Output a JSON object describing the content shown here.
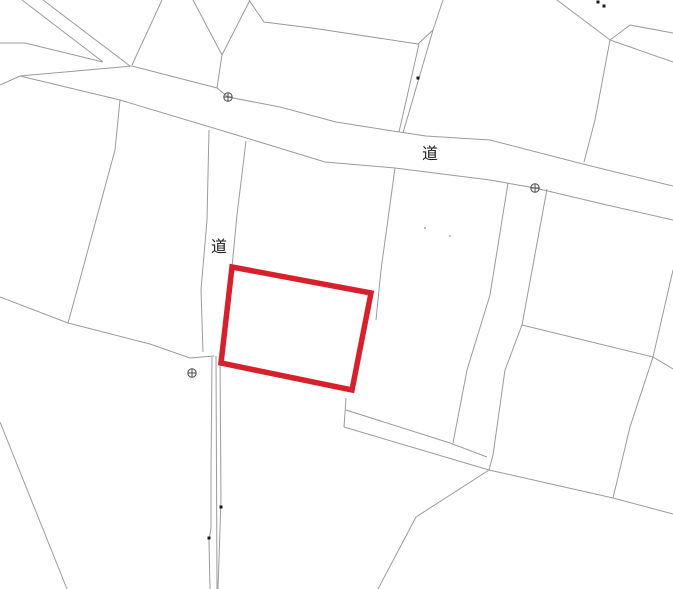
{
  "map": {
    "width": 673,
    "height": 589,
    "background": "#ffffff",
    "boundary_color": "#9b9b9b",
    "boundary_width": 1,
    "labels": [
      {
        "text": "道",
        "x": 430,
        "y": 153,
        "font_size": 16
      },
      {
        "text": "道",
        "x": 219,
        "y": 246,
        "font_size": 16
      }
    ],
    "highlight_parcel": {
      "color": "#d6202c",
      "stroke_width": 5.5,
      "points": [
        [
          232,
          267
        ],
        [
          371,
          293
        ],
        [
          352,
          390
        ],
        [
          221,
          363
        ]
      ]
    },
    "survey_markers": {
      "color": "#4a4a4a",
      "radius": 4.2,
      "positions": [
        [
          228,
          97
        ],
        [
          535,
          188
        ],
        [
          192,
          373
        ]
      ]
    },
    "boundaries": [
      [
        [
          22,
          0
        ],
        [
          103,
          62
        ]
      ],
      [
        [
          43,
          0
        ],
        [
          130,
          66
        ]
      ],
      [
        [
          0,
          43
        ],
        [
          25,
          43
        ],
        [
          103,
          62
        ]
      ],
      [
        [
          0,
          85
        ],
        [
          20,
          76
        ]
      ],
      [
        [
          20,
          76
        ],
        [
          132,
          66
        ],
        [
          217,
          88
        ],
        [
          228,
          97
        ],
        [
          280,
          107
        ],
        [
          336,
          122
        ],
        [
          399,
          132
        ],
        [
          426,
          136
        ],
        [
          490,
          140
        ],
        [
          579,
          163
        ],
        [
          607,
          170
        ],
        [
          673,
          186
        ]
      ],
      [
        [
          20,
          76
        ],
        [
          120,
          100
        ],
        [
          230,
          133
        ],
        [
          325,
          162
        ],
        [
          395,
          168
        ],
        [
          490,
          180
        ],
        [
          535,
          188
        ],
        [
          607,
          205
        ],
        [
          673,
          220
        ]
      ],
      [
        [
          162,
          0
        ],
        [
          132,
          65
        ]
      ],
      [
        [
          193,
          0
        ],
        [
          222,
          55
        ]
      ],
      [
        [
          250,
          0
        ],
        [
          222,
          55
        ]
      ],
      [
        [
          222,
          55
        ],
        [
          217,
          88
        ]
      ],
      [
        [
          249,
          0
        ],
        [
          264,
          22
        ],
        [
          312,
          28
        ],
        [
          418,
          44
        ]
      ],
      [
        [
          419,
          44
        ],
        [
          399,
          132
        ]
      ],
      [
        [
          433,
          30
        ],
        [
          403,
          133
        ]
      ],
      [
        [
          418,
          44
        ],
        [
          433,
          30
        ]
      ],
      [
        [
          443,
          0
        ],
        [
          433,
          30
        ]
      ],
      [
        [
          557,
          0
        ],
        [
          610,
          40
        ]
      ],
      [
        [
          610,
          40
        ],
        [
          630,
          25
        ],
        [
          673,
          33
        ]
      ],
      [
        [
          610,
          40
        ],
        [
          673,
          62
        ]
      ],
      [
        [
          610,
          40
        ],
        [
          595,
          120
        ],
        [
          584,
          162
        ]
      ],
      [
        [
          120,
          100
        ],
        [
          115,
          150
        ],
        [
          76,
          294
        ],
        [
          68,
          323
        ]
      ],
      [
        [
          0,
          297
        ],
        [
          68,
          323
        ],
        [
          150,
          344
        ],
        [
          190,
          358
        ],
        [
          214,
          356
        ]
      ],
      [
        [
          0,
          422
        ],
        [
          67,
          589
        ]
      ],
      [
        [
          209,
          130
        ],
        [
          207,
          220
        ],
        [
          201,
          290
        ],
        [
          203,
          352
        ]
      ],
      [
        [
          246,
          141
        ],
        [
          237,
          215
        ],
        [
          232,
          267
        ]
      ],
      [
        [
          212,
          357
        ],
        [
          211,
          470
        ],
        [
          211,
          528
        ],
        [
          209,
          540
        ],
        [
          210,
          589
        ]
      ],
      [
        [
          216,
          356
        ],
        [
          217,
          589
        ]
      ],
      [
        [
          220,
          357
        ],
        [
          221,
          500
        ],
        [
          218,
          589
        ]
      ],
      [
        [
          395,
          168
        ],
        [
          381,
          270
        ],
        [
          376,
          320
        ]
      ],
      [
        [
          346,
          398
        ],
        [
          344,
          427
        ]
      ],
      [
        [
          346,
          410
        ],
        [
          450,
          443
        ],
        [
          487,
          457
        ]
      ],
      [
        [
          344,
          427
        ],
        [
          489,
          470
        ]
      ],
      [
        [
          508,
          183
        ],
        [
          490,
          295
        ],
        [
          467,
          370
        ],
        [
          453,
          443
        ]
      ],
      [
        [
          547,
          189
        ],
        [
          522,
          325
        ],
        [
          505,
          370
        ],
        [
          493,
          455
        ],
        [
          489,
          470
        ]
      ],
      [
        [
          522,
          325
        ],
        [
          653,
          357
        ],
        [
          673,
          369
        ]
      ],
      [
        [
          673,
          270
        ],
        [
          653,
          357
        ],
        [
          630,
          427
        ],
        [
          613,
          498
        ]
      ],
      [
        [
          489,
          470
        ],
        [
          613,
          498
        ],
        [
          673,
          514
        ]
      ],
      [
        [
          489,
          470
        ],
        [
          416,
          517
        ],
        [
          378,
          589
        ]
      ]
    ],
    "specks": {
      "color": "#1a1a1a",
      "size": 3,
      "positions": [
        [
          598,
          2
        ],
        [
          604,
          6
        ],
        [
          418,
          78
        ],
        [
          221,
          507
        ],
        [
          209,
          538
        ]
      ]
    },
    "faint_specks": {
      "color": "#c0c0c0",
      "size": 2,
      "positions": [
        [
          425,
          228
        ],
        [
          450,
          236
        ]
      ]
    }
  }
}
